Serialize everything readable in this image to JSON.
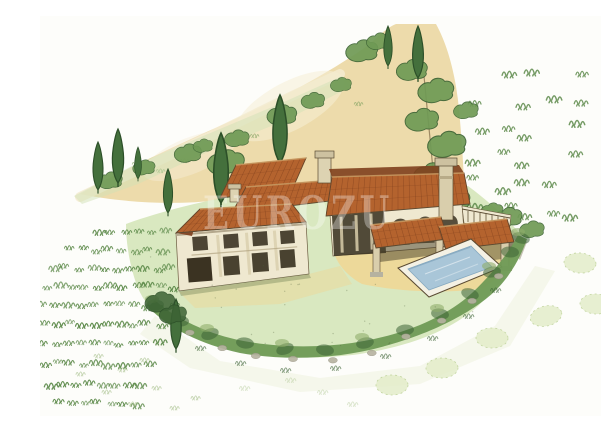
{
  "image": {
    "kind": "watercolor and ink artist impression (aerial three-quarter view)",
    "subject": "Hillside Provencal stone villa with terracotta tiled roofs, arcaded loggia, pergola terrace, swimming pool, cypress trees, clipped hedge border and planted field rows",
    "background": "white paper",
    "watermark": {
      "text": "EUROZU",
      "color": "#ffffff",
      "opacity": 0.32
    }
  },
  "palette": {
    "paper": "#fdfdfa",
    "hill": "#ecd9a6",
    "hill_light": "#f6eed6",
    "lawn": "#d7e7bd",
    "sand": "#eed898",
    "roof": "#b4632e",
    "roof_dark": "#7e3f1d",
    "roof_light": "#e0a96a",
    "wall": "#efe8d0",
    "wall_shadow": "#b9ad8e",
    "opening": "#3b3322",
    "stone": "#b6b2a0",
    "hedge": "#6f9a55",
    "hedge_dark": "#3c6334",
    "hedge_light": "#8fae6b",
    "cypress": "#44703c",
    "cypress_dark": "#2c4f28",
    "scrub": "#5d8a4a",
    "olive_pale": "#e4edca",
    "pool": "#a9c6d8",
    "pool_deep": "#86a9c0",
    "ink": "#5a4a32"
  },
  "scene": {
    "elements": [
      {
        "name": "hillside",
        "desc": "pale sandy hill rising behind the house toward the top of the sheet"
      },
      {
        "name": "tree-line",
        "desc": "diagonal row of bushes and tall cypress trees along the upper-left slope"
      },
      {
        "name": "scrubland-tufts",
        "desc": "scattered grass tufts dotting the right-hand slope"
      },
      {
        "name": "villa",
        "desc": "two-storey stone farmhouse of several terracotta roof volumes with chimneys and a dark arcaded loggia"
      },
      {
        "name": "pergola-terrace",
        "desc": "sandy terrace with two tiled pergolas on stone pillars at the right of the house"
      },
      {
        "name": "swimming-pool",
        "desc": "rectangular pool with pale coping set into the terrace, lower right of the villa"
      },
      {
        "name": "garden-hedge",
        "desc": "curving clipped hedge with stones bordering the lawn below the house"
      },
      {
        "name": "vineyard-rows",
        "desc": "rows of small planted tufts covering the left field"
      },
      {
        "name": "olive-trees",
        "desc": "faint pale olive canopies scattered outside the hedge, lower right"
      },
      {
        "name": "lawn",
        "desc": "light green watercolor lawn surrounding the buildings"
      }
    ]
  }
}
